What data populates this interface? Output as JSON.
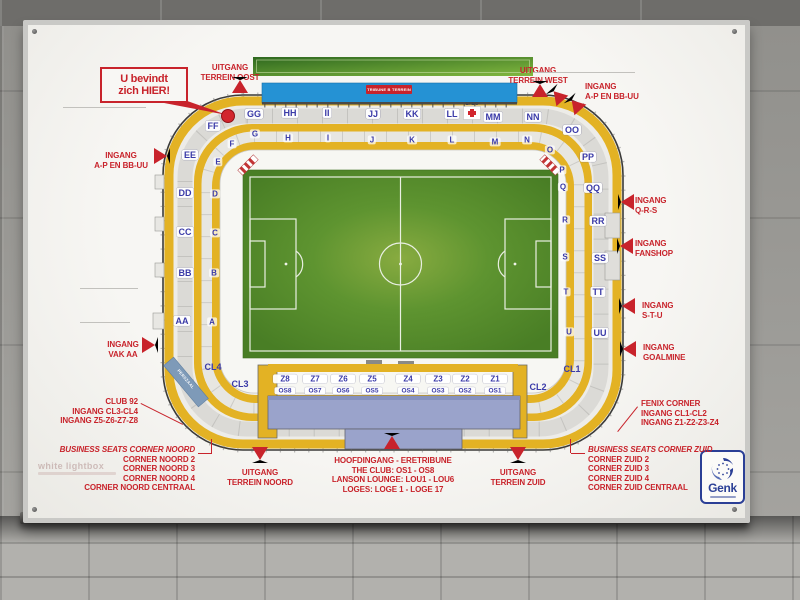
{
  "colors": {
    "accent_red": "#C8232B",
    "concourse_yellow": "#E3B224",
    "pitch_green": "#57912D",
    "stand_blue": "#2592D4",
    "eretribune_blue": "#9AA3CB",
    "press_band_blue": "#7E9AB8",
    "section_text_blue": "#3A3AA8",
    "top_green_bar": "#4E8A2C"
  },
  "sign": {
    "you_are_here": {
      "line1": "U bevindt",
      "line2": "zich HIER!"
    },
    "stand_badge": "TRIBUNE B TERREIN",
    "ehbo": "EHBO",
    "press_room": "PERSZAAL",
    "watermark_brand": "white lightbox",
    "genk": {
      "name": "Genk"
    },
    "red_labels": [
      {
        "id": "uitgang-terrein-oost",
        "lines": [
          "UITGANG",
          "TERREIN OOST"
        ],
        "x": 202,
        "y": 38,
        "align": "center"
      },
      {
        "id": "ingang-a-p-en-bb-uu-left",
        "lines": [
          "INGANG",
          "A-P EN BB-UU"
        ],
        "x": 93,
        "y": 126,
        "align": "center"
      },
      {
        "id": "ingang-vak-aa",
        "lines": [
          "INGANG",
          "VAK AA"
        ],
        "x": 95,
        "y": 315,
        "align": "center"
      },
      {
        "id": "uitgang-terrein-west",
        "lines": [
          "UITGANG",
          "TERREIN WEST"
        ],
        "x": 510,
        "y": 41,
        "align": "center"
      },
      {
        "id": "ingang-a-p-en-bb-uu-right",
        "lines": [
          "INGANG",
          "A-P EN BB-UU"
        ],
        "x": 557,
        "y": 57,
        "align": "left"
      },
      {
        "id": "ingang-q-r-s",
        "lines": [
          "INGANG",
          "Q-R-S"
        ],
        "x": 607,
        "y": 171,
        "align": "left"
      },
      {
        "id": "ingang-fanshop",
        "lines": [
          "INGANG",
          "FANSHOP"
        ],
        "x": 607,
        "y": 214,
        "align": "left"
      },
      {
        "id": "ingang-s-t-u",
        "lines": [
          "INGANG",
          "S-T-U"
        ],
        "x": 614,
        "y": 276,
        "align": "left"
      },
      {
        "id": "ingang-goalmine",
        "lines": [
          "INGANG",
          "GOALMINE"
        ],
        "x": 615,
        "y": 318,
        "align": "left"
      },
      {
        "id": "fenix-corner",
        "lines": [
          "FENIX CORNER",
          "INGANG CL1-CL2",
          "INGANG Z1-Z2-Z3-Z4"
        ],
        "x": 613,
        "y": 374,
        "align": "left"
      },
      {
        "id": "business-seats-corner-zuid",
        "lines": [
          "BUSINESS SEATS CORNER ZUID",
          "CORNER ZUID 2",
          "CORNER ZUID 3",
          "CORNER ZUID 4",
          "CORNER ZUID CENTRAAL"
        ],
        "x": 560,
        "y": 420,
        "align": "left",
        "italic_first": true
      },
      {
        "id": "club-92",
        "lines": [
          "CLUB 92",
          "INGANG CL3-CL4",
          "INGANG Z5-Z6-Z7-Z8"
        ],
        "x": 110,
        "y": 372,
        "align": "right"
      },
      {
        "id": "business-seats-corner-noord",
        "lines": [
          "BUSINESS SEATS CORNER NOORD",
          "CORNER NOORD 2",
          "CORNER NOORD 3",
          "CORNER NOORD 4",
          "CORNER NOORD CENTRAAL"
        ],
        "x": 167,
        "y": 420,
        "align": "right",
        "italic_first": true
      },
      {
        "id": "uitgang-terrein-noord",
        "lines": [
          "UITGANG",
          "TERREIN NOORD"
        ],
        "x": 232,
        "y": 443,
        "align": "center"
      },
      {
        "id": "hoofdingang-eretribune",
        "lines": [
          "HOOFDINGANG - ERETRIBUNE",
          "THE CLUB: OS1 - OS8",
          "LANSON LOUNGE: LOU1 - LOU6",
          "LOGES: LOGE 1 - LOGE 17"
        ],
        "x": 365,
        "y": 431,
        "align": "center"
      },
      {
        "id": "uitgang-terrein-zuid",
        "lines": [
          "UITGANG",
          "TERREIN ZUID"
        ],
        "x": 490,
        "y": 443,
        "align": "center"
      }
    ],
    "arrows": [
      {
        "dir": "up",
        "x": 212,
        "y": 60
      },
      {
        "dir": "up",
        "x": 512,
        "y": 64
      },
      {
        "dir": "upleft",
        "x": 529,
        "y": 70
      },
      {
        "dir": "upleft",
        "x": 547,
        "y": 79
      },
      {
        "dir": "right",
        "x": 134,
        "y": 131
      },
      {
        "dir": "right",
        "x": 122,
        "y": 320
      },
      {
        "dir": "left",
        "x": 598,
        "y": 177
      },
      {
        "dir": "left",
        "x": 597,
        "y": 221
      },
      {
        "dir": "left",
        "x": 599,
        "y": 281
      },
      {
        "dir": "left",
        "x": 600,
        "y": 324
      },
      {
        "dir": "down",
        "x": 232,
        "y": 430
      },
      {
        "dir": "up",
        "x": 364,
        "y": 416
      },
      {
        "dir": "down",
        "x": 490,
        "y": 430
      }
    ],
    "leaders": [
      {
        "x1": 35,
        "y1": 82,
        "x2": 118,
        "y2": 82,
        "c": "#c2c1bd"
      },
      {
        "x1": 505,
        "y1": 47,
        "x2": 607,
        "y2": 47,
        "c": "#c2c1bd"
      },
      {
        "x1": 52,
        "y1": 263,
        "x2": 110,
        "y2": 263,
        "c": "#c2c1bd"
      },
      {
        "x1": 52,
        "y1": 297,
        "x2": 102,
        "y2": 297,
        "c": "#c2c1bd"
      },
      {
        "x1": 113,
        "y1": 378,
        "x2": 155,
        "y2": 399,
        "c": "#C8232B"
      },
      {
        "x1": 610,
        "y1": 382,
        "x2": 590,
        "y2": 407,
        "c": "#C8232B"
      },
      {
        "x1": 170,
        "y1": 428,
        "x2": 184,
        "y2": 428,
        "c": "#C8232B"
      },
      {
        "x1": 184,
        "y1": 414,
        "x2": 184,
        "y2": 428,
        "c": "#C8232B"
      },
      {
        "x1": 543,
        "y1": 428,
        "x2": 557,
        "y2": 428,
        "c": "#C8232B"
      },
      {
        "x1": 543,
        "y1": 414,
        "x2": 543,
        "y2": 428,
        "c": "#C8232B"
      }
    ],
    "sections_outer": [
      {
        "t": "FF",
        "x": 185,
        "y": 101
      },
      {
        "t": "GG",
        "x": 226,
        "y": 89
      },
      {
        "t": "HH",
        "x": 262,
        "y": 88
      },
      {
        "t": "II",
        "x": 299,
        "y": 88
      },
      {
        "t": "JJ",
        "x": 345,
        "y": 89
      },
      {
        "t": "KK",
        "x": 384,
        "y": 89
      },
      {
        "t": "LL",
        "x": 424,
        "y": 89
      },
      {
        "t": "MM",
        "x": 465,
        "y": 92
      },
      {
        "t": "NN",
        "x": 505,
        "y": 92
      },
      {
        "t": "OO",
        "x": 544,
        "y": 105
      },
      {
        "t": "PP",
        "x": 560,
        "y": 132
      },
      {
        "t": "QQ",
        "x": 565,
        "y": 163
      },
      {
        "t": "RR",
        "x": 570,
        "y": 196
      },
      {
        "t": "SS",
        "x": 572,
        "y": 233
      },
      {
        "t": "TT",
        "x": 570,
        "y": 267
      },
      {
        "t": "UU",
        "x": 572,
        "y": 308
      },
      {
        "t": "EE",
        "x": 162,
        "y": 130
      },
      {
        "t": "DD",
        "x": 157,
        "y": 168
      },
      {
        "t": "CC",
        "x": 157,
        "y": 207
      },
      {
        "t": "BB",
        "x": 157,
        "y": 248
      },
      {
        "t": "AA",
        "x": 154,
        "y": 296
      }
    ],
    "sections_inner": [
      {
        "t": "F",
        "x": 204,
        "y": 119
      },
      {
        "t": "E",
        "x": 190,
        "y": 137
      },
      {
        "t": "G",
        "x": 227,
        "y": 109
      },
      {
        "t": "H",
        "x": 260,
        "y": 113
      },
      {
        "t": "I",
        "x": 300,
        "y": 113
      },
      {
        "t": "J",
        "x": 344,
        "y": 115
      },
      {
        "t": "K",
        "x": 384,
        "y": 115
      },
      {
        "t": "L",
        "x": 424,
        "y": 115
      },
      {
        "t": "M",
        "x": 467,
        "y": 117
      },
      {
        "t": "N",
        "x": 499,
        "y": 115
      },
      {
        "t": "O",
        "x": 522,
        "y": 125
      },
      {
        "t": "P",
        "x": 534,
        "y": 145
      },
      {
        "t": "Q",
        "x": 535,
        "y": 162
      },
      {
        "t": "R",
        "x": 537,
        "y": 195
      },
      {
        "t": "S",
        "x": 537,
        "y": 232
      },
      {
        "t": "T",
        "x": 538,
        "y": 267
      },
      {
        "t": "U",
        "x": 541,
        "y": 307
      },
      {
        "t": "D",
        "x": 187,
        "y": 169
      },
      {
        "t": "C",
        "x": 187,
        "y": 208
      },
      {
        "t": "B",
        "x": 186,
        "y": 248
      },
      {
        "t": "A",
        "x": 184,
        "y": 297
      }
    ],
    "sections_cl": [
      {
        "t": "CL4",
        "x": 185,
        "y": 342
      },
      {
        "t": "CL3",
        "x": 212,
        "y": 359
      },
      {
        "t": "CL2",
        "x": 510,
        "y": 362
      },
      {
        "t": "CL1",
        "x": 544,
        "y": 344
      }
    ],
    "sections_z": [
      {
        "t": "Z8",
        "x": 257,
        "y": 354
      },
      {
        "t": "Z7",
        "x": 287,
        "y": 354
      },
      {
        "t": "Z6",
        "x": 315,
        "y": 354
      },
      {
        "t": "Z5",
        "x": 344,
        "y": 354
      },
      {
        "t": "Z4",
        "x": 380,
        "y": 354
      },
      {
        "t": "Z3",
        "x": 410,
        "y": 354
      },
      {
        "t": "Z2",
        "x": 437,
        "y": 354
      },
      {
        "t": "Z1",
        "x": 467,
        "y": 354
      }
    ],
    "sections_os": [
      {
        "t": "OS8",
        "x": 257,
        "y": 366
      },
      {
        "t": "OS7",
        "x": 287,
        "y": 366
      },
      {
        "t": "OS6",
        "x": 315,
        "y": 366
      },
      {
        "t": "OS5",
        "x": 344,
        "y": 366
      },
      {
        "t": "OS4",
        "x": 380,
        "y": 366
      },
      {
        "t": "OS3",
        "x": 410,
        "y": 366
      },
      {
        "t": "OS2",
        "x": 437,
        "y": 366
      },
      {
        "t": "OS1",
        "x": 467,
        "y": 366
      }
    ]
  }
}
